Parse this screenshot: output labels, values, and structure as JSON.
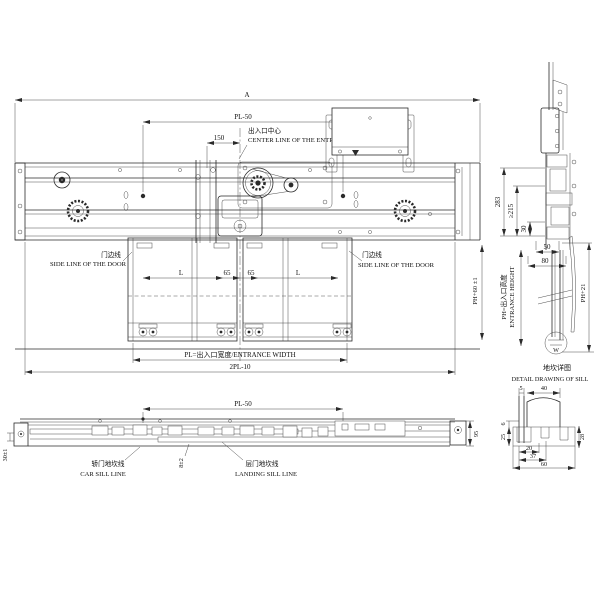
{
  "colors": {
    "ink": "#2a2a2a",
    "paper": "#ffffff"
  },
  "top_view": {
    "dim_a": "A",
    "dim_pl50": "PL-50",
    "dim_150": "150",
    "entrance_center_cn": "出入口中心",
    "entrance_center_en": "CENTER LINE OF THE ENTRANCE",
    "side_line_left_cn": "门边线",
    "side_line_left_en": "SIDE LINE OF THE DOOR",
    "side_line_right_cn": "门边线",
    "side_line_right_en": "SIDE LINE OF THE DOOR",
    "dim_l_left": "L",
    "dim_65_a": "65",
    "dim_65_b": "65",
    "dim_l_right": "L",
    "dim_entrance_width": "PL=出入口宽度/ENTRANCE WIDTH",
    "dim_2pl10": "2PL-10"
  },
  "side_view": {
    "dim_283": "283",
    "dim_215": "≥215",
    "dim_30": "30",
    "dim_50": "50",
    "dim_80": "80",
    "dim_ph60": "PH+60 ±1",
    "dim_ph_cn": "PH=出入口高度",
    "dim_ph_en": "ENTRANCE HEIGHT",
    "dim_ph21": "PH+21",
    "detail_mark": "W"
  },
  "sill_detail": {
    "title_cn": "地坎详图",
    "title_en": "DETAIL DRAWING OF SILL",
    "dim_5": "5",
    "dim_40": "40",
    "dim_6": "6",
    "dim_25": "25",
    "dim_28": "28",
    "dim_20": "20",
    "dim_37": "37",
    "dim_60": "60"
  },
  "bottom_view": {
    "dim_pl50": "PL-50",
    "dim_30": "30±1",
    "dim_8": "8±2",
    "dim_95": "95",
    "car_sill_cn": "轿门地坎线",
    "car_sill_en": "CAR SILL LINE",
    "landing_sill_cn": "层门地坎线",
    "landing_sill_en": "LANDING SILL LINE"
  }
}
